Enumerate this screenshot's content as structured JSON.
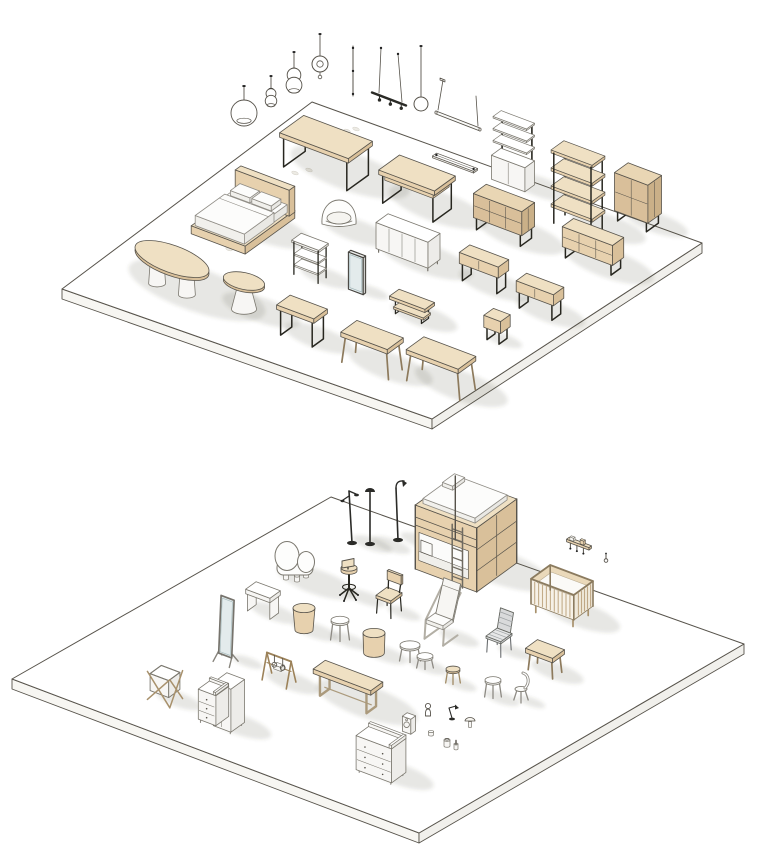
{
  "meta": {
    "kind": "isometric-furniture-library-render",
    "canvas": {
      "width": 768,
      "height": 864
    }
  },
  "palette": {
    "bg": "#ffffff",
    "ink": "#57534b",
    "metal": "#27261f",
    "grayLine": "#7b786f",
    "woodTop": "#efe0c3",
    "woodL": "#e7d1ae",
    "woodR": "#d9c09a",
    "woodDeepTop": "#e9d6b4",
    "woodDeepL": "#d9bf9a",
    "woodDeepR": "#cab088",
    "whiteTop": "#ffffff",
    "whiteL": "#f7f6f4",
    "whiteR": "#edece9",
    "softTop": "#fcfcfb",
    "softL": "#f1f0ec",
    "softR": "#e9e8e4",
    "softLine": "#8f8c85",
    "grayTop": "#e6e7e7",
    "grayL": "#d9dadb",
    "grayR": "#cdced0",
    "grayInk": "#63655f",
    "glass": "#e3ebec",
    "tanLine": "#9c8259",
    "platformSideA": "#f7f6f2",
    "platformSideB": "#f1f0ec",
    "shadow": "rgba(72,66,50,0.13)"
  },
  "platforms": [
    {
      "name": "display-platform-top",
      "corners": [
        [
          312,
          102
        ],
        [
          702,
          243
        ],
        [
          432,
          419
        ],
        [
          62,
          289
        ]
      ],
      "thickness": 10
    },
    {
      "name": "display-platform-bottom",
      "corners": [
        [
          331,
          497
        ],
        [
          744,
          644
        ],
        [
          419,
          833
        ],
        [
          12,
          679
        ]
      ],
      "thickness": 10
    }
  ],
  "items": [
    {
      "name": "pendant-light-globe",
      "t": "pendant",
      "sub": "globe",
      "x": 244,
      "y": 126,
      "top": 86,
      "r": 13
    },
    {
      "name": "pendant-light-bell-small",
      "t": "pendant",
      "sub": "bell",
      "x": 271,
      "y": 106,
      "top": 76,
      "r": 8
    },
    {
      "name": "pendant-light-bell",
      "t": "pendant",
      "sub": "bell",
      "x": 294,
      "y": 92,
      "top": 52,
      "r": 11
    },
    {
      "name": "pendant-light-disc",
      "t": "pendant",
      "sub": "disc",
      "x": 320,
      "y": 64,
      "top": 34,
      "r": 8
    },
    {
      "name": "pendant-light-rod",
      "t": "pendant",
      "sub": "rod",
      "x": 353,
      "y": 96,
      "top": 46
    },
    {
      "name": "pendant-light-linear",
      "t": "pendant",
      "sub": "linear",
      "x": 389,
      "y": 99,
      "top": 48
    },
    {
      "name": "pendant-light-sphere",
      "t": "pendant",
      "sub": "sphere",
      "x": 421,
      "y": 104,
      "top": 46,
      "r": 7
    },
    {
      "name": "pendant-light-tube",
      "t": "pendant",
      "sub": "tube",
      "x": 458,
      "y": 120,
      "top": 80
    },
    {
      "name": "recessed-light-profile",
      "t": "lightbar",
      "x": 455,
      "y": 164,
      "len": 44
    },
    {
      "name": "floor-marks",
      "t": "marks",
      "pts": [
        [
          295,
          173
        ],
        [
          309,
          170
        ],
        [
          347,
          131
        ],
        [
          356,
          129
        ],
        [
          268,
          196
        ],
        [
          229,
          249
        ],
        [
          258,
          215
        ]
      ]
    },
    {
      "name": "dining-table",
      "t": "table",
      "x": 326,
      "y": 171,
      "w": 74,
      "d": 30,
      "h": 34,
      "legs": "metalU",
      "pal": "wood"
    },
    {
      "name": "desk",
      "t": "table",
      "x": 417,
      "y": 206,
      "w": 60,
      "d": 26,
      "h": 33,
      "legs": "metalU",
      "pal": "wood",
      "apron": 1
    },
    {
      "name": "double-bed",
      "t": "bed",
      "x": 243,
      "y": 226,
      "w": 58,
      "d": 62,
      "h": 30
    },
    {
      "name": "armchair",
      "t": "armchair",
      "x": 339,
      "y": 230,
      "w": 40,
      "h": 34
    },
    {
      "name": "wall-shelf-unit",
      "t": "wallshelf",
      "x": 513,
      "y": 186,
      "w": 36,
      "d": 13,
      "h": 64
    },
    {
      "name": "shelving-unit",
      "t": "shelf",
      "x": 578,
      "y": 226,
      "w": 44,
      "d": 16,
      "h": 70,
      "pal": "wood"
    },
    {
      "name": "cabinet",
      "t": "box",
      "x": 638,
      "y": 222,
      "w": 36,
      "d": 17,
      "h": 38,
      "legH": 10,
      "legs": "loop",
      "doorsU": 2,
      "drawersH": 2,
      "sideDiv": 1,
      "pal": "woodDeep"
    },
    {
      "name": "sideboard",
      "t": "box",
      "x": 504,
      "y": 234,
      "w": 52,
      "d": 16,
      "h": 24,
      "legH": 12,
      "legs": "loop",
      "doorsU": 3,
      "drawersH": 2,
      "sideDiv": 1,
      "pal": "woodDeep"
    },
    {
      "name": "sideboard-white",
      "t": "box",
      "x": 408,
      "y": 258,
      "w": 56,
      "d": 15,
      "h": 26,
      "legH": 4,
      "legs": "four",
      "doorsU": 4,
      "pal": "white"
    },
    {
      "name": "console-etagere",
      "t": "etagere",
      "x": 310,
      "y": 276,
      "w": 28,
      "d": 12,
      "h": 35
    },
    {
      "name": "floor-mirror",
      "t": "mirror",
      "x": 357,
      "y": 291,
      "w": 16,
      "h": 37
    },
    {
      "name": "console-shelf",
      "t": "box",
      "x": 593,
      "y": 263,
      "w": 54,
      "d": 14,
      "h": 20,
      "legH": 11,
      "legs": "loop",
      "doorsU": 3,
      "drawersH": 2,
      "pal": "wood"
    },
    {
      "name": "console-table",
      "t": "box",
      "x": 484,
      "y": 284,
      "w": 42,
      "d": 13,
      "h": 11,
      "legH": 17,
      "legs": "loop",
      "doorsU": 2,
      "pal": "wood"
    },
    {
      "name": "console-table-2",
      "t": "box",
      "x": 540,
      "y": 311,
      "w": 40,
      "d": 13,
      "h": 11,
      "legH": 16,
      "legs": "loop",
      "doorsU": 2,
      "pal": "wood"
    },
    {
      "name": "tv-bench",
      "t": "tvbench",
      "x": 412,
      "y": 316,
      "w": 38,
      "d": 12,
      "h": 17
    },
    {
      "name": "nightstand",
      "t": "box",
      "x": 497,
      "y": 339,
      "w": 18,
      "d": 12,
      "h": 12,
      "legH": 12,
      "legs": "loop",
      "pal": "wood"
    },
    {
      "name": "oval-table",
      "t": "ovaltable",
      "x": 172,
      "y": 289,
      "r": 39,
      "h": 30
    },
    {
      "name": "round-table",
      "t": "roundtable",
      "x": 244,
      "y": 309,
      "r": 21,
      "h": 28
    },
    {
      "name": "desk-metal-frame",
      "t": "table",
      "x": 302,
      "y": 337,
      "w": 40,
      "d": 17,
      "h": 30,
      "legs": "metalU",
      "pal": "wood"
    },
    {
      "name": "table-trestle",
      "t": "table",
      "x": 372,
      "y": 366,
      "w": 50,
      "d": 20,
      "h": 31,
      "legs": "wood4",
      "pal": "wood"
    },
    {
      "name": "dining-table-2",
      "t": "table",
      "x": 441,
      "y": 385,
      "w": 56,
      "d": 22,
      "h": 32,
      "legs": "wood4",
      "pal": "wood"
    },
    {
      "name": "floor-lamp-task",
      "t": "floorlamp",
      "sub": "task",
      "x": 352,
      "y": 543,
      "h": 52
    },
    {
      "name": "floor-lamp",
      "t": "floorlamp",
      "sub": "dome",
      "x": 370,
      "y": 544,
      "h": 54
    },
    {
      "name": "floor-lamp-arc",
      "t": "floorlamp",
      "sub": "arc",
      "x": 398,
      "y": 540,
      "h": 58
    },
    {
      "name": "bunk-bed",
      "t": "bunk",
      "x": 466,
      "y": 566,
      "w": 66,
      "d": 50,
      "h": 64
    },
    {
      "name": "wall-rack",
      "t": "wallrack",
      "x": 579,
      "y": 553,
      "w": 24
    },
    {
      "name": "wall-hook",
      "t": "acc",
      "sub": "hook",
      "x": 606,
      "y": 563
    },
    {
      "name": "crib",
      "t": "crib",
      "x": 562,
      "y": 614,
      "w": 46,
      "d": 24,
      "h": 34
    },
    {
      "name": "kids-chair-sculptural",
      "t": "sculpt",
      "x": 296,
      "y": 581,
      "w": 46,
      "h": 38
    },
    {
      "name": "desk-chair",
      "t": "swivel",
      "x": 349,
      "y": 597,
      "h": 42
    },
    {
      "name": "kids-desk",
      "t": "table",
      "x": 263,
      "y": 612,
      "w": 26,
      "d": 13,
      "h": 22,
      "legs": "panel",
      "pal": "white"
    },
    {
      "name": "pouf",
      "t": "pouf",
      "x": 304,
      "y": 630,
      "r": 11,
      "h": 22,
      "taper": 0.82,
      "pal": "wood"
    },
    {
      "name": "cheval-mirror",
      "t": "cheval",
      "x": 226,
      "y": 661,
      "w": 14,
      "h": 60
    },
    {
      "name": "dining-chair",
      "t": "chair",
      "sub": "wood",
      "x": 389,
      "y": 612,
      "w": 16,
      "h": 38
    },
    {
      "name": "lounge-chair",
      "t": "lounge",
      "x": 441,
      "y": 637,
      "h": 46
    },
    {
      "name": "stool-round",
      "t": "stool",
      "sub": "legs",
      "x": 340,
      "y": 640,
      "r": 9,
      "h": 20,
      "pal": "white"
    },
    {
      "name": "outdoor-chair",
      "t": "chair",
      "sub": "metal",
      "x": 499,
      "y": 651,
      "w": 16,
      "h": 40
    },
    {
      "name": "side-table",
      "t": "pouf",
      "x": 374,
      "y": 653,
      "r": 11,
      "h": 20,
      "taper": 0.94,
      "pal": "wood"
    },
    {
      "name": "nesting-tables",
      "t": "nesting",
      "x": 417,
      "y": 665
    },
    {
      "name": "kids-table",
      "t": "table",
      "x": 545,
      "y": 671,
      "w": 29,
      "d": 15,
      "h": 22,
      "legs": "wood4",
      "pal": "wood"
    },
    {
      "name": "kids-stool",
      "t": "stool",
      "sub": "legs",
      "x": 453,
      "y": 683,
      "r": 7,
      "h": 14,
      "pal": "wood"
    },
    {
      "name": "stool-round-2",
      "t": "stool",
      "sub": "legs",
      "x": 493,
      "y": 697,
      "r": 8,
      "h": 17,
      "pal": "white"
    },
    {
      "name": "kids-chair",
      "t": "chair",
      "sub": "kidback",
      "x": 521,
      "y": 701,
      "w": 12,
      "h": 26
    },
    {
      "name": "bench",
      "t": "bench",
      "x": 348,
      "y": 701,
      "w": 62,
      "d": 15,
      "h": 25
    },
    {
      "name": "laundry-hamper",
      "t": "hamper",
      "x": 165,
      "y": 699,
      "w": 24,
      "h": 30
    },
    {
      "name": "dresser",
      "t": "dresserTray",
      "x": 221,
      "y": 724,
      "w": 36,
      "d": 17,
      "h": 38,
      "split": 1,
      "drawers": 3,
      "pal": "white"
    },
    {
      "name": "play-gym",
      "t": "gym",
      "x": 279,
      "y": 681,
      "w": 30,
      "h": 26
    },
    {
      "name": "changing-table",
      "t": "dresserTray",
      "x": 381,
      "y": 774,
      "w": 38,
      "d": 18,
      "h": 40,
      "drawers": 3,
      "pal": "white"
    },
    {
      "name": "speaker",
      "t": "acc",
      "sub": "speaker",
      "x": 409,
      "y": 731
    },
    {
      "name": "toy-figure",
      "t": "acc",
      "sub": "figure",
      "x": 428,
      "y": 716
    },
    {
      "name": "desk-lamp",
      "t": "acc",
      "sub": "desklamp",
      "x": 452,
      "y": 719
    },
    {
      "name": "table-lamp",
      "t": "acc",
      "sub": "mushroom",
      "x": 470,
      "y": 727
    },
    {
      "name": "jar",
      "t": "acc",
      "sub": "jar",
      "x": 447,
      "y": 746
    },
    {
      "name": "bottle",
      "t": "acc",
      "sub": "bottle",
      "x": 456,
      "y": 749
    },
    {
      "name": "cup",
      "t": "acc",
      "sub": "cup",
      "x": 431,
      "y": 735
    }
  ]
}
